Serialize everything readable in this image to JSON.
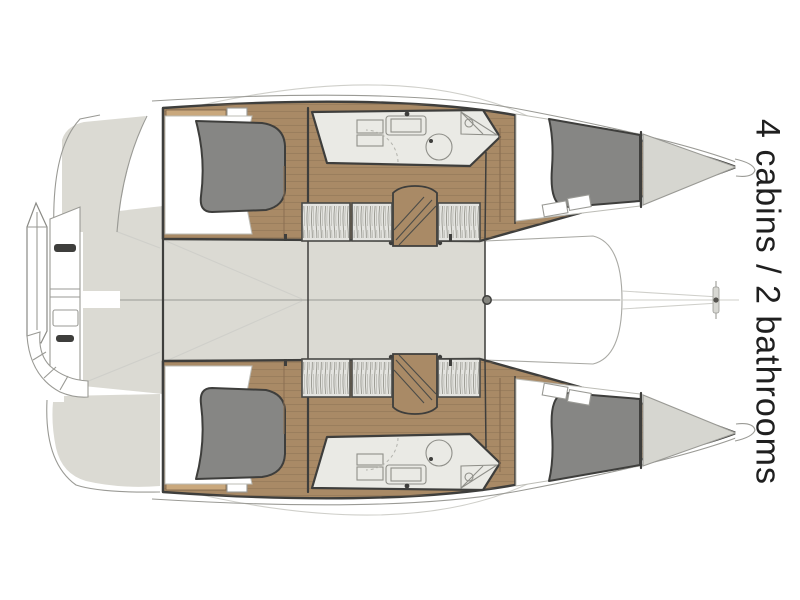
{
  "caption": {
    "text": "4 cabins / 2 bathrooms"
  },
  "plan": {
    "cabins": 4,
    "bathrooms": 2,
    "areas": [
      "aft-cabin-port",
      "bathroom-port",
      "forward-cabin-port",
      "bow-locker-port",
      "aft-cabin-starboard",
      "bathroom-starboard",
      "forward-cabin-starboard",
      "bow-locker-starboard",
      "saloon-deck",
      "foredeck",
      "trampoline",
      "stern-platforms",
      "mast-base"
    ]
  },
  "palette": {
    "ink": "#1f1f1f",
    "wood": "#a98a66",
    "wood_light": "#c9a87d",
    "plank_line": "#8a6e51",
    "deck": "#dbdad3",
    "bed_duvet": "#868684",
    "bed_sheet": "#ffffff",
    "bath_floor": "#eaeae5",
    "wardrobe": "#e4e4e0",
    "locker": "#d6d6d0",
    "outline_dark": "#3e3e3c",
    "outline_mid": "#9a9a95",
    "faint": "#cfcfca"
  }
}
